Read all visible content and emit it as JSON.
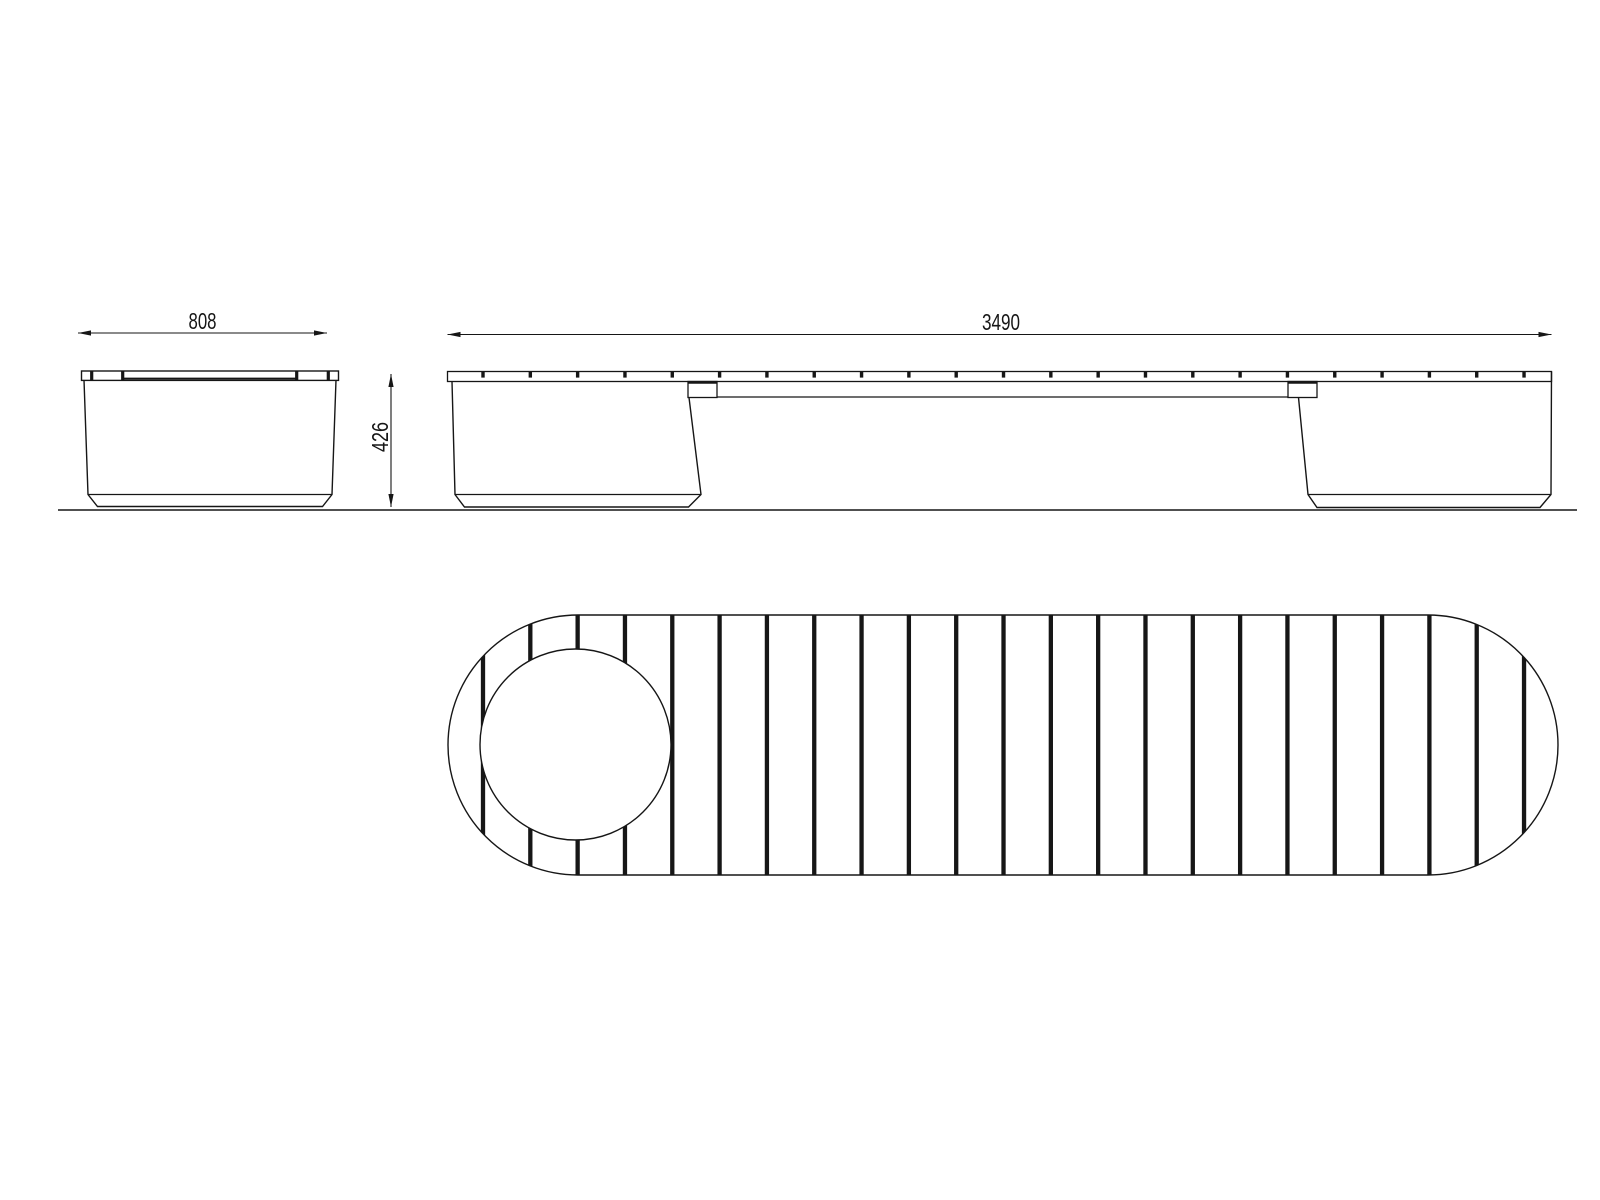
{
  "drawing": {
    "background_color": "#ffffff",
    "line_color": "#161616",
    "dimensions": {
      "end_width": "808",
      "overall_length": "3490",
      "height": "426"
    },
    "plan_view": {
      "slat_gap_count": 23,
      "has_planter_circle": true
    },
    "side_view": {
      "plank_joint_count": 23,
      "bracket_count": 2
    },
    "end_view": {
      "plank_joint_count": 4
    }
  }
}
